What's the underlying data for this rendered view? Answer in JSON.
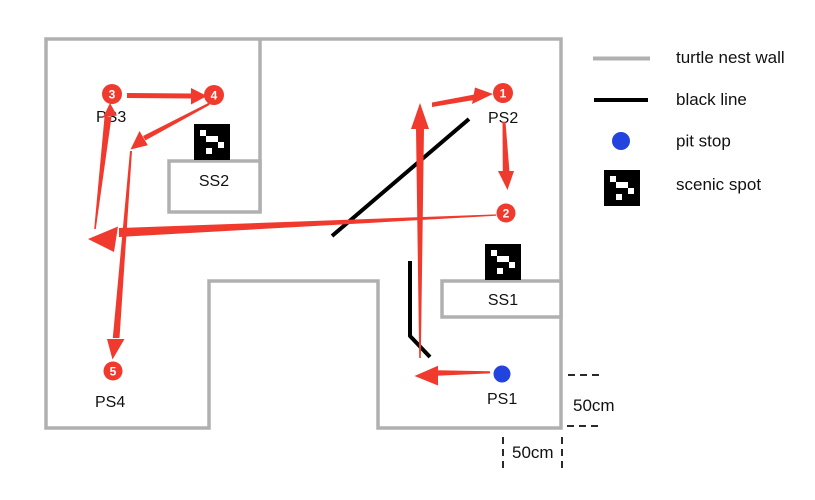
{
  "legend": {
    "items": [
      {
        "label": "turtle nest wall"
      },
      {
        "label": "black line"
      },
      {
        "label": "pit stop"
      },
      {
        "label": "scenic spot"
      }
    ]
  },
  "map": {
    "station_labels": {
      "ps1": "PS1",
      "ps2": "PS2",
      "ps3": "PS3",
      "ps4": "PS4",
      "ss1": "SS1",
      "ss2": "SS2"
    },
    "waypoint_numbers": [
      "1",
      "2",
      "3",
      "4",
      "5"
    ],
    "dimension_labels": {
      "right": "50cm",
      "bottom": "50cm"
    }
  },
  "colors": {
    "wall": "#b0b0b0",
    "black_line": "#000000",
    "pit_stop_blue": "#2343df",
    "route_red": "#f03a2e"
  }
}
